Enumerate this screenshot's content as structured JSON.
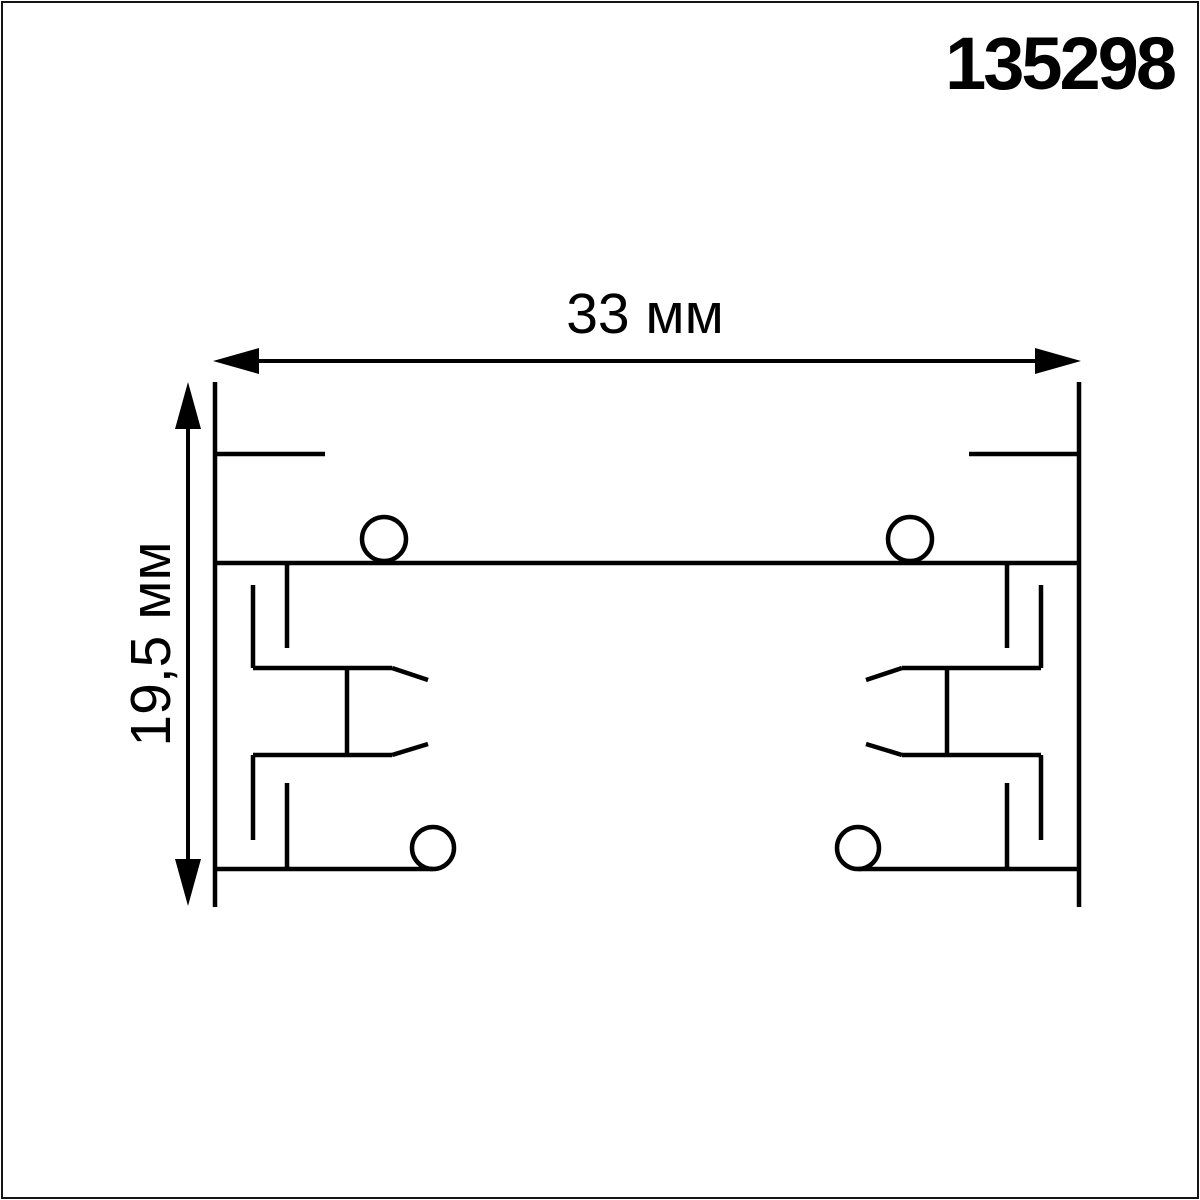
{
  "article_number": "135298",
  "drawing": {
    "type": "technical-cross-section",
    "subject": "track lighting busbar profile cross-section",
    "line_color": "#000000",
    "background": "#ffffff",
    "frame_color": "#141414",
    "dimensions": {
      "width": {
        "label": "33 мм",
        "value_mm": 33
      },
      "height": {
        "label": "19,5 мм",
        "value_mm": 19.5
      }
    },
    "geometry": {
      "profile_segments": [
        [
          215,
          382,
          215,
          907
        ],
        [
          1079,
          382,
          1079,
          907
        ],
        [
          215,
          454,
          325,
          454
        ],
        [
          969,
          454,
          1079,
          454
        ],
        [
          215,
          563,
          1079,
          563
        ],
        [
          287,
          563,
          287,
          648
        ],
        [
          1007,
          563,
          1007,
          648
        ],
        [
          253,
          585,
          253,
          668
        ],
        [
          1041,
          585,
          1041,
          668
        ],
        [
          253,
          668,
          392,
          668
        ],
        [
          902,
          668,
          1041,
          668
        ],
        [
          392,
          668,
          428,
          680
        ],
        [
          902,
          668,
          866,
          680
        ],
        [
          347,
          668,
          347,
          755
        ],
        [
          947,
          668,
          947,
          755
        ],
        [
          253,
          755,
          392,
          755
        ],
        [
          902,
          755,
          1041,
          755
        ],
        [
          392,
          755,
          428,
          744
        ],
        [
          902,
          755,
          866,
          744
        ],
        [
          253,
          755,
          253,
          840
        ],
        [
          1041,
          755,
          1041,
          840
        ],
        [
          287,
          783,
          287,
          869
        ],
        [
          1007,
          783,
          1007,
          869
        ],
        [
          215,
          869,
          433,
          869
        ],
        [
          858,
          869,
          1079,
          869
        ]
      ],
      "dimension_segments": [
        [
          259,
          361,
          1035,
          361
        ],
        [
          188,
          429,
          188,
          859
        ]
      ],
      "circles": [
        [
          384,
          539,
          22
        ],
        [
          910,
          539,
          22
        ],
        [
          433,
          848,
          21
        ],
        [
          858,
          848,
          21
        ]
      ],
      "arrowheads": [
        "213,361 259,348 259,374",
        "1081,361 1035,348 1035,374",
        "188,382 175,429 201,429",
        "188,906 175,859 201,859"
      ],
      "profile_stroke_width": 4.5,
      "dimension_stroke_width": 4
    }
  }
}
